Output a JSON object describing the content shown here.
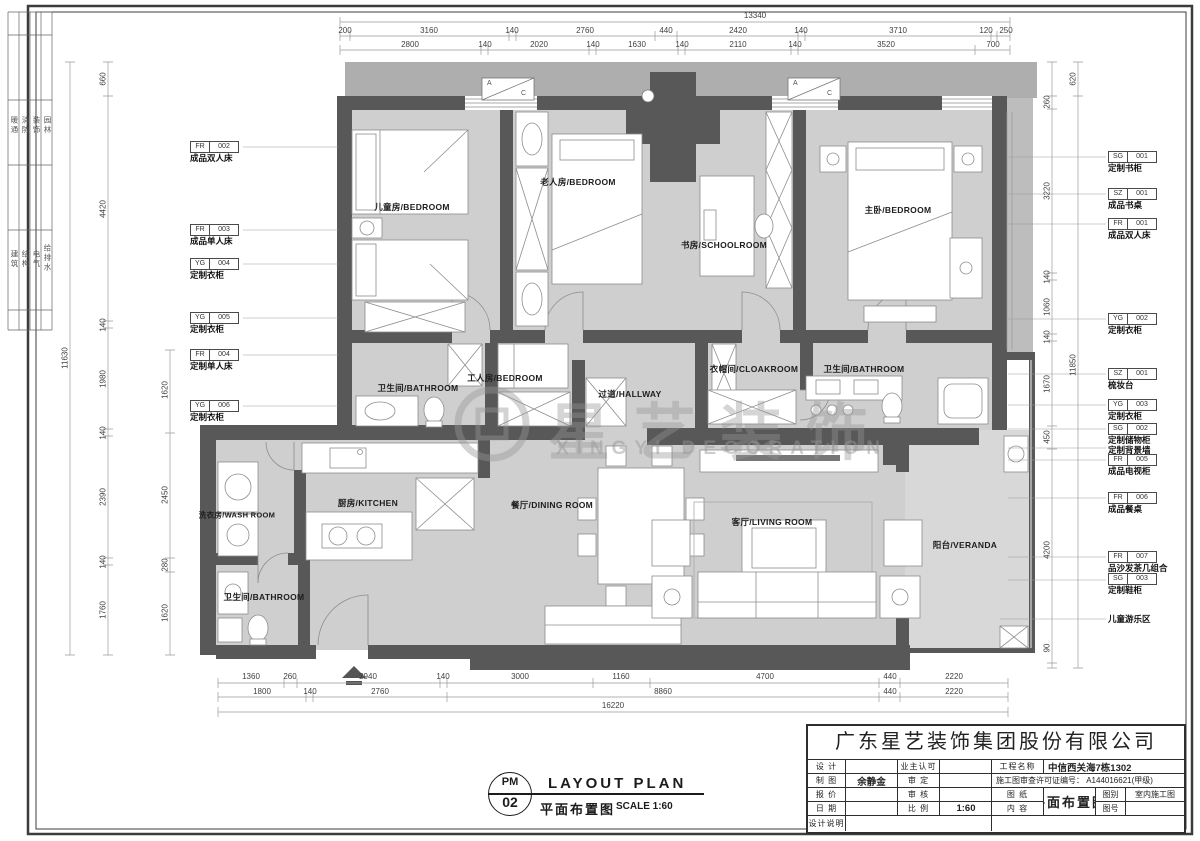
{
  "sheet": {
    "disciplines": {
      "group1": [
        "暖通",
        "消防",
        "装饰",
        "园林"
      ],
      "group2": [
        "建筑",
        "结构",
        "电气",
        "给排水"
      ]
    },
    "watermark": {
      "cn": "星艺装饰",
      "en": "XINGYI DECORATION"
    },
    "ac_a": "A",
    "ac_c": "C",
    "colors": {
      "wall": "#585858",
      "floor": "#cfcfcf",
      "ledge": "#aeaeae"
    }
  },
  "rooms": {
    "kids": "儿童房/BEDROOM",
    "elder": "老人房/BEDROOM",
    "study": "书房/SCHOOLROOM",
    "master": "主卧/BEDROOM",
    "bath1": "卫生间/BATHROOM",
    "worker": "工人房/BEDROOM",
    "hallway": "过道/HALLWAY",
    "cloak": "衣帽间/CLOAKROOM",
    "bath2": "卫生间/BATHROOM",
    "wash": "洗衣房/WASH ROOM",
    "kitchen": "厨房/KITCHEN",
    "dining": "餐厅/DINING ROOM",
    "living": "客厅/LIVING ROOM",
    "veranda": "阳台/VERANDA",
    "bath3": "卫生间/BATHROOM"
  },
  "tags_left": [
    {
      "code": "FR",
      "num": "002",
      "label": "成品双人床"
    },
    {
      "code": "FR",
      "num": "003",
      "label": "成品单人床"
    },
    {
      "code": "YG",
      "num": "004",
      "label": "定制衣柜"
    },
    {
      "code": "YG",
      "num": "005",
      "label": "定制衣柜"
    },
    {
      "code": "FR",
      "num": "004",
      "label": "定制单人床"
    },
    {
      "code": "YG",
      "num": "006",
      "label": "定制衣柜"
    }
  ],
  "tags_right": [
    {
      "code": "SG",
      "num": "001",
      "label": "定制书柜"
    },
    {
      "code": "SZ",
      "num": "001",
      "label": "成品书桌"
    },
    {
      "code": "FR",
      "num": "001",
      "label": "成品双人床"
    },
    {
      "code": "YG",
      "num": "002",
      "label": "定制衣柜"
    },
    {
      "code": "SZ",
      "num": "001",
      "label": "梳妆台"
    },
    {
      "code": "YG",
      "num": "003",
      "label": "定制衣柜"
    },
    {
      "code": "SG",
      "num": "002",
      "label": "定制储物柜"
    },
    {
      "code": "FR",
      "num": "005",
      "label": "成品电视柜"
    },
    {
      "code": "FR",
      "num": "006",
      "label": "成品餐桌"
    },
    {
      "code": "FR",
      "num": "007",
      "label": "品沙发茶几组合"
    },
    {
      "code": "SG",
      "num": "003",
      "label": "定制鞋柜"
    }
  ],
  "notes": {
    "backwall": "定制背景墙",
    "play_area": "儿童游乐区"
  },
  "dims": {
    "top": {
      "overall": "13340",
      "row1": [
        "200",
        "3160",
        "140",
        "2760",
        "440",
        "2420",
        "140",
        "3710",
        "120",
        "250"
      ],
      "row2": [
        "2800",
        "140",
        "2020",
        "140",
        "1630",
        "140",
        "2110",
        "140",
        "3520",
        "700"
      ]
    },
    "bottom": {
      "row1": [
        "1360",
        "260",
        "2940",
        "140",
        "3000",
        "1160",
        "4700",
        "440",
        "2220"
      ],
      "row2": [
        "1800",
        "140",
        "2760",
        "8860",
        "440",
        "2220"
      ],
      "overall": "16220"
    },
    "left": {
      "outer": [
        "660",
        "4420",
        "140",
        "1980",
        "140",
        "2390",
        "140",
        "1760"
      ],
      "overall": "11630",
      "inner": [
        "1620",
        "2450",
        "280",
        "1620"
      ]
    },
    "right": {
      "outer_top": "620",
      "overall": "11850",
      "inner": [
        "260",
        "3220",
        "140",
        "1060",
        "140",
        "1670",
        "450",
        "4200",
        "90"
      ]
    }
  },
  "plan_symbol": {
    "code_top": "PM",
    "code_num": "02",
    "title_en": "LAYOUT PLAN",
    "title_cn": "平面布置图",
    "scale": "SCALE 1:60"
  },
  "titleblock": {
    "company": "广东星艺装饰集团股份有限公司",
    "design_label": "设 计",
    "draw_label": "制 图",
    "draw_value": "余静金",
    "quote_label": "报 价",
    "date_label": "日 期",
    "note_label": "设计说明",
    "owner_label": "业主认可",
    "approve_label": "审 定",
    "check_label": "审 核",
    "scale_label": "比 例",
    "scale_value": "1:60",
    "project_label": "工程名称",
    "project_value": "中信西关海7栋1302",
    "permit": "施工图审查许可证编号： A144016621(甲级)",
    "sheet_label": "图 纸",
    "content_label": "内 容",
    "content_value": "平面布置图",
    "type_label": "图别",
    "type_value": "室内施工图",
    "no_label": "图号"
  }
}
